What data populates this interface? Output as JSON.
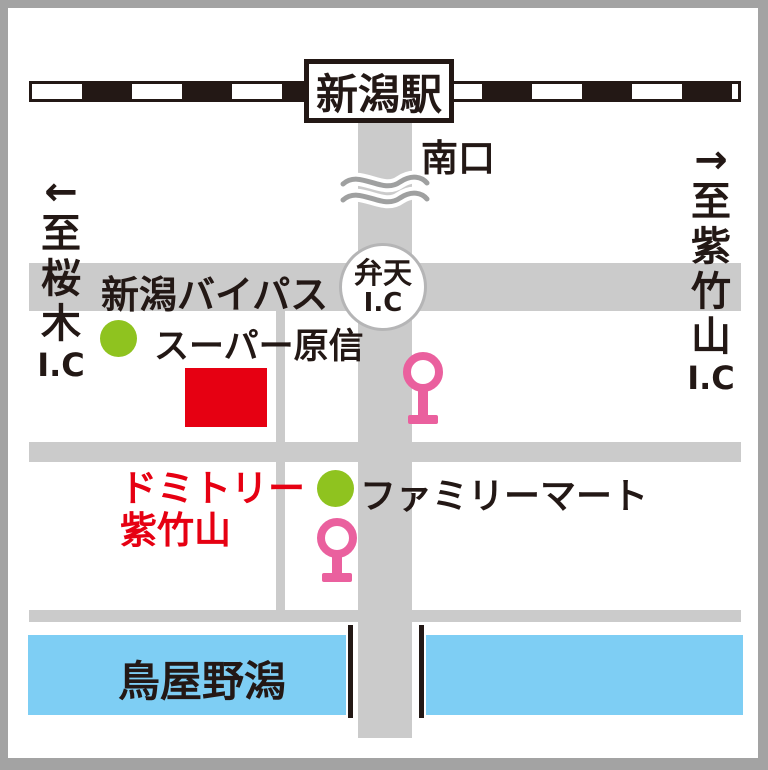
{
  "station": {
    "label": "新潟駅"
  },
  "south_exit": {
    "label": "南口"
  },
  "directions": {
    "left": {
      "arrow": "←",
      "chars": [
        "至",
        "桜",
        "木"
      ],
      "ic": "I.C"
    },
    "right": {
      "arrow": "→",
      "chars": [
        "至",
        "紫",
        "竹",
        "山"
      ],
      "ic": "I.C"
    }
  },
  "roads": {
    "bypass_label": "新潟バイパス",
    "benten_interchange": {
      "line1": "弁天",
      "line2": "I.C"
    }
  },
  "landmarks": {
    "supermarket": {
      "label": "スーパー原信",
      "marker": "green-dot"
    },
    "convenience_store": {
      "label": "ファミリーマート",
      "marker": "green-dot"
    },
    "destination": {
      "line1": "ドミトリー",
      "line2": "紫竹山",
      "marker": "red-rectangle"
    },
    "lagoon": {
      "label": "鳥屋野潟"
    }
  },
  "symbols": {
    "traffic_lights": 2,
    "railway": "dashed-black-white-line",
    "road_break": "wavy-lines"
  },
  "colors": {
    "road_gray": "#cbcbcb",
    "frame_gray": "#a3a3a3",
    "ink_black": "#231815",
    "destination_red": "#e60012",
    "landmark_green": "#8fc31f",
    "traffic_light_pink": "#ea609e",
    "water_blue": "#7ecef4",
    "wave_gray": "#9fa0a0"
  }
}
